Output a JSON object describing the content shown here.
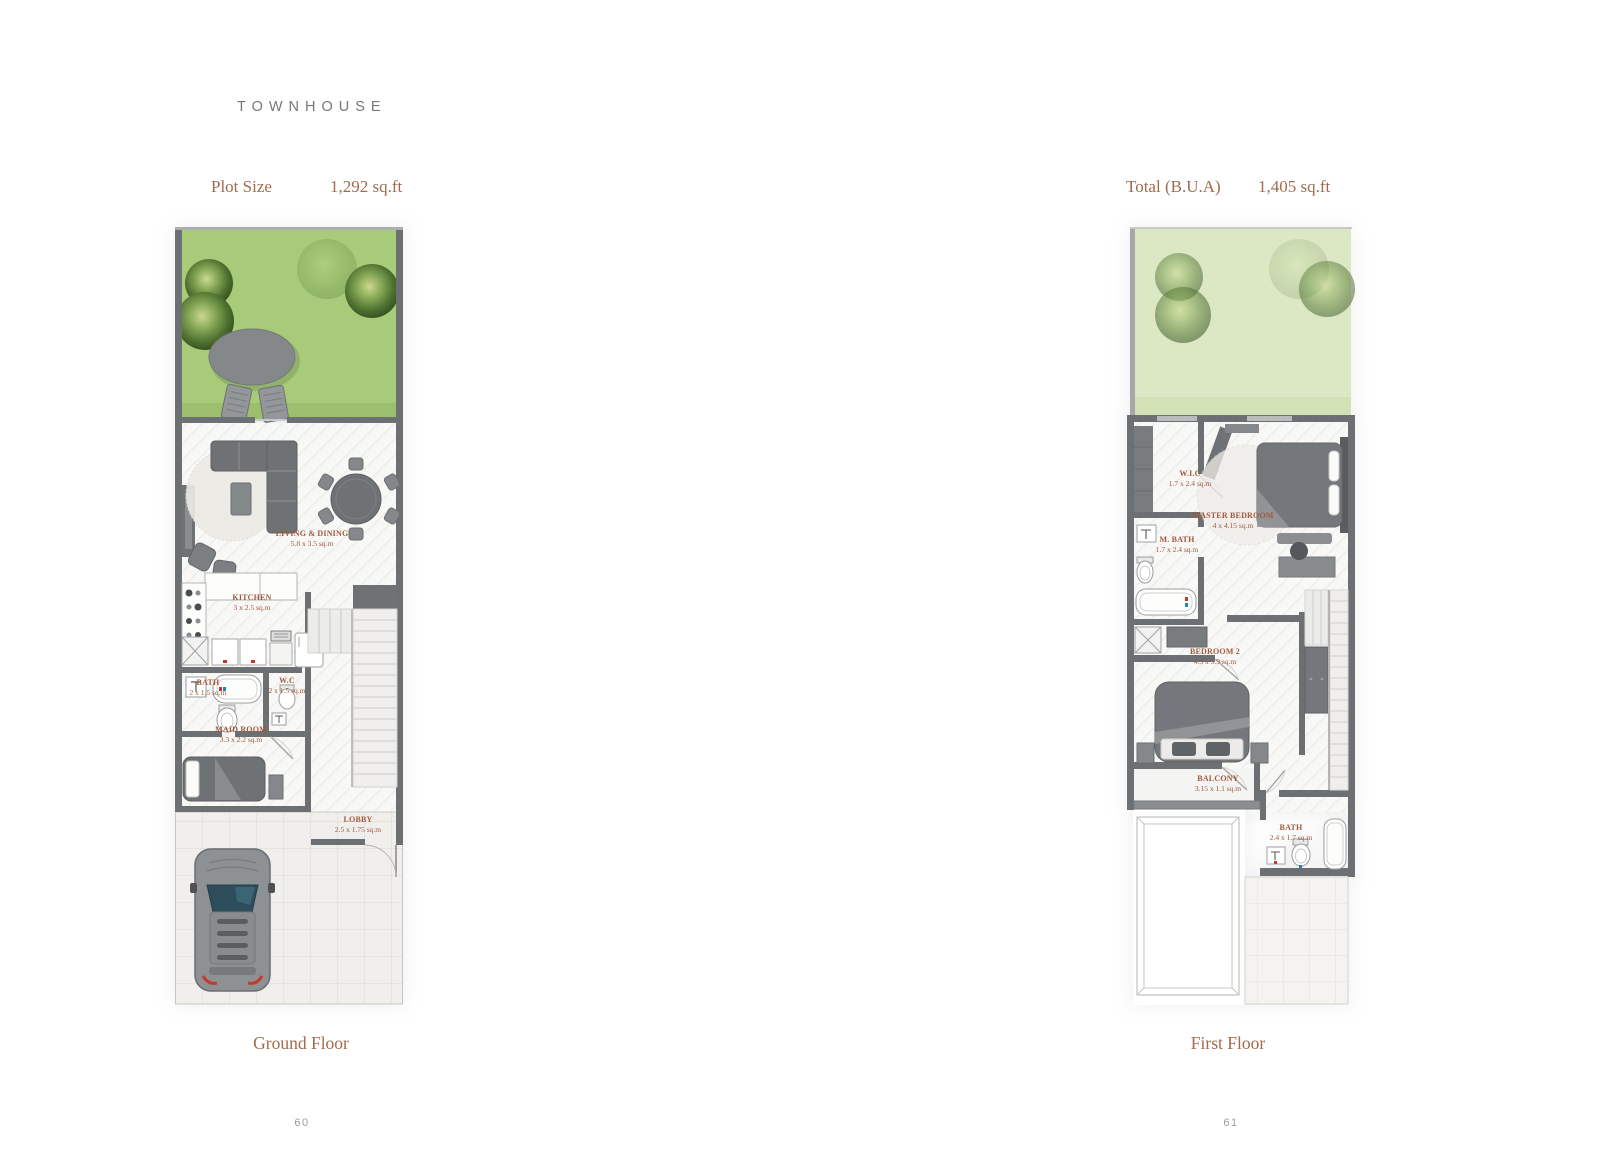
{
  "header": {
    "title": "TOWNHOUSE",
    "plot": {
      "label": "Plot Size",
      "value": "1,292 sq.ft"
    },
    "bua": {
      "label": "Total (B.U.A)",
      "value": "1,405 sq.ft"
    }
  },
  "ground_floor": {
    "caption": "Ground Floor",
    "page_number": "60",
    "rooms": {
      "living_dining": {
        "name": "LIVING & DINING",
        "dims": "5.8 x 3.5 sq.m"
      },
      "kitchen": {
        "name": "KITCHEN",
        "dims": "3 x 2.5 sq.m"
      },
      "bath": {
        "name": "BATH",
        "dims": "2 x 1.5 sq.m"
      },
      "wc": {
        "name": "W.C",
        "dims": "2 x 1.5 sq.m"
      },
      "maid_room": {
        "name": "MAID ROOM",
        "dims": "3.3 x 2.2 sq.m"
      },
      "lobby": {
        "name": "LOBBY",
        "dims": "2.5 x 1.75 sq.m"
      }
    }
  },
  "first_floor": {
    "caption": "First Floor",
    "page_number": "61",
    "rooms": {
      "wic": {
        "name": "W.I.C",
        "dims": "1.7 x 2.4 sq.m"
      },
      "m_bath": {
        "name": "M. BATH",
        "dims": "1.7 x 2.4 sq.m"
      },
      "master_bedroom": {
        "name": "MASTER BEDROOM",
        "dims": "4 x 4.15 sq.m"
      },
      "bedroom_2": {
        "name": "BEDROOM 2",
        "dims": "4.5 x 3.9 sq.m"
      },
      "balcony": {
        "name": "BALCONY",
        "dims": "3.15 x 1.1 sq.m"
      },
      "bath": {
        "name": "BATH",
        "dims": "2.4 x 1.7 sq.m"
      }
    }
  },
  "colors": {
    "accent_brown": "#a16b4c",
    "room_label_brown": "#a2583d",
    "title_gray": "#76777a",
    "wall_gray": "#6d7073",
    "lawn_green": "#a7cb78",
    "lawn_faded_green": "#dce8c4",
    "page_number_gray": "#9c9c9c"
  }
}
